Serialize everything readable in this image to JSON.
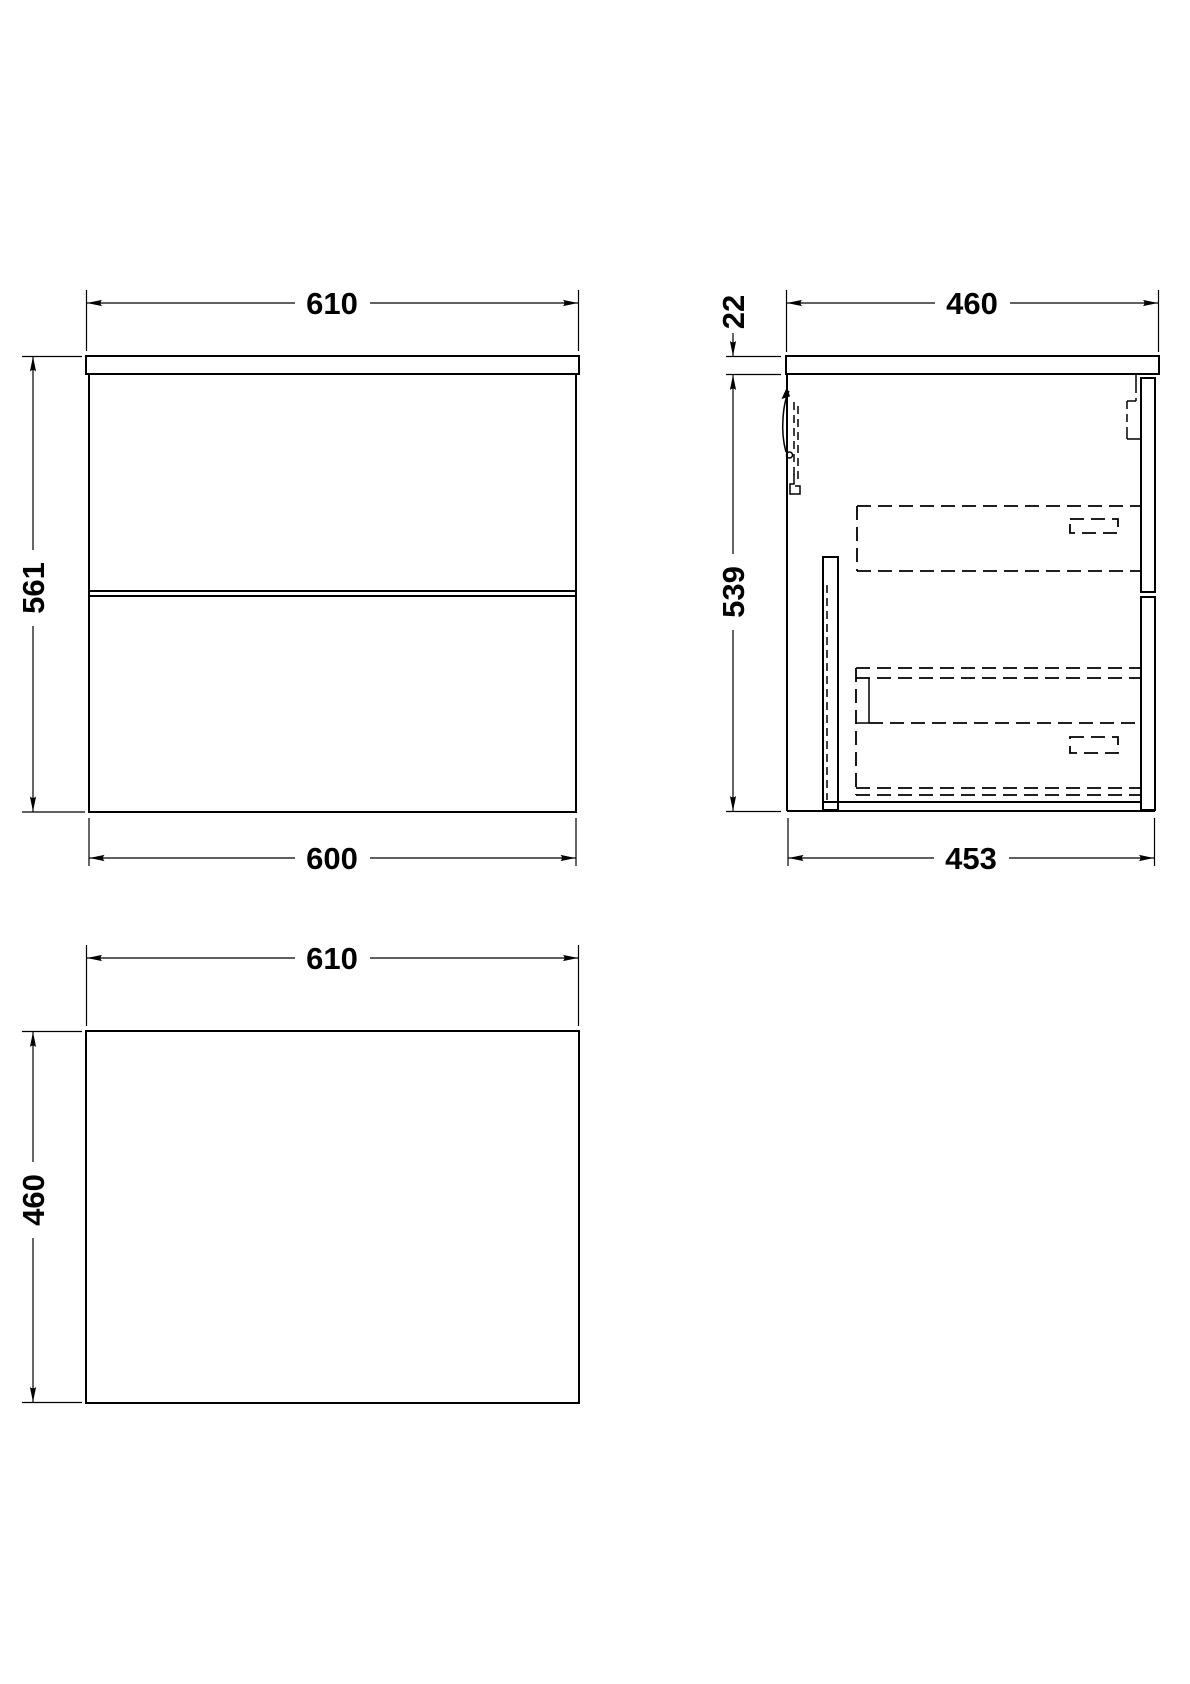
{
  "page": {
    "background_color": "#ffffff",
    "line_color": "#000000",
    "description": "Orthographic technical drawing of a wall-hung two-drawer vanity unit with worktop"
  },
  "drawing": {
    "views": [
      {
        "id": "front",
        "name": "front-elevation",
        "dimensions": [
          {
            "id": "front-top-width",
            "value": "610"
          },
          {
            "id": "front-height",
            "value": "561"
          },
          {
            "id": "front-bottom-width",
            "value": "600"
          }
        ]
      },
      {
        "id": "side",
        "name": "side-section",
        "dimensions": [
          {
            "id": "side-top-depth",
            "value": "460"
          },
          {
            "id": "side-worktop-thickness",
            "value": "22"
          },
          {
            "id": "side-cabinet-height",
            "value": "539"
          },
          {
            "id": "side-bottom-depth",
            "value": "453"
          }
        ]
      },
      {
        "id": "plan",
        "name": "plan-view",
        "dimensions": [
          {
            "id": "plan-width",
            "value": "610"
          },
          {
            "id": "plan-depth",
            "value": "460"
          }
        ]
      }
    ]
  }
}
